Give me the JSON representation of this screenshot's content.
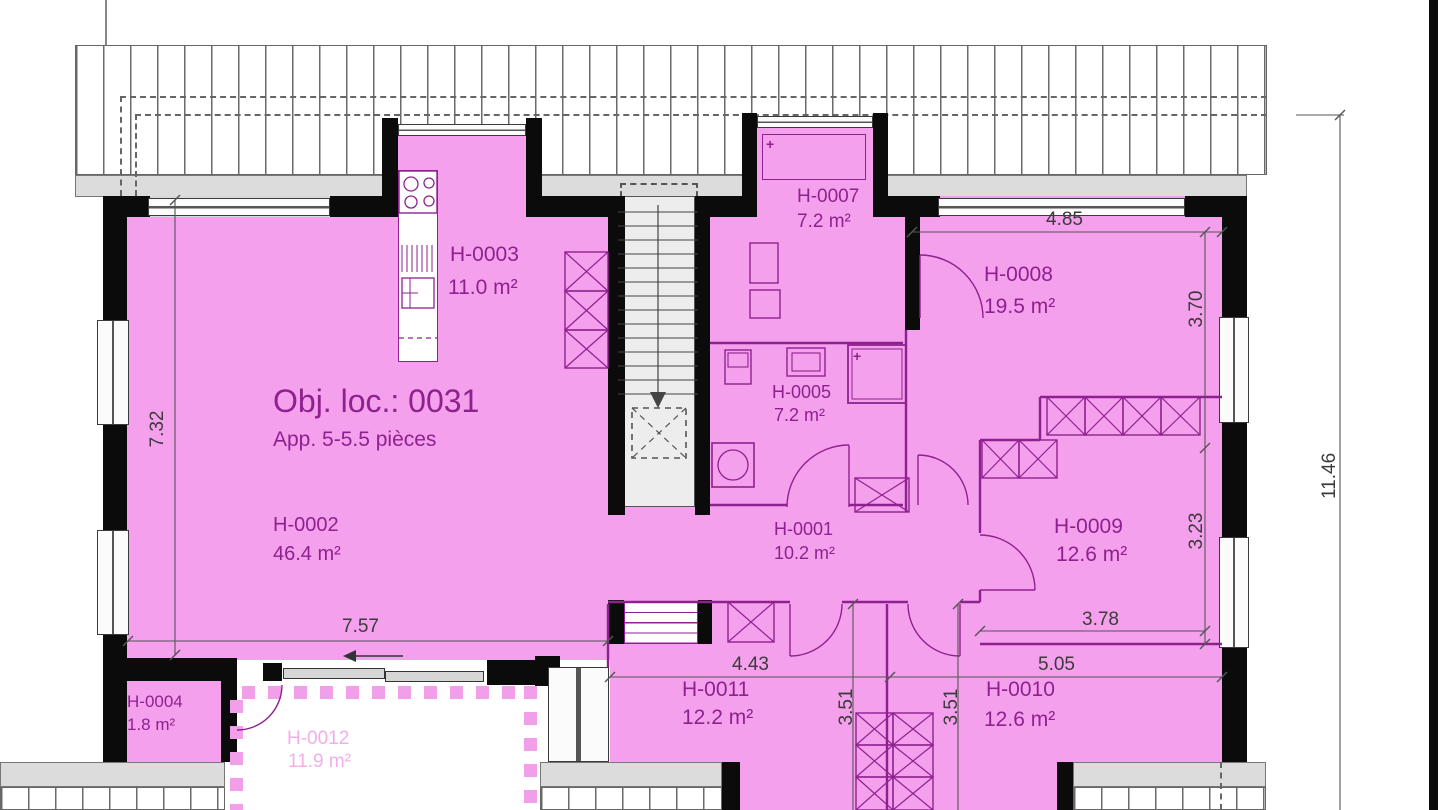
{
  "title": {
    "object": "Obj. loc.: 0031",
    "type": "App. 5-5.5 pièces"
  },
  "rooms": {
    "h0001": {
      "id": "H-0001",
      "area": "10.2 m²"
    },
    "h0002": {
      "id": "H-0002",
      "area": "46.4 m²"
    },
    "h0003": {
      "id": "H-0003",
      "area": "11.0 m²"
    },
    "h0004": {
      "id": "H-0004",
      "area": "1.8 m²"
    },
    "h0005": {
      "id": "H-0005",
      "area": "7.2 m²"
    },
    "h0007": {
      "id": "H-0007",
      "area": "7.2 m²"
    },
    "h0008": {
      "id": "H-0008",
      "area": "19.5 m²"
    },
    "h0009": {
      "id": "H-0009",
      "area": "12.6 m²"
    },
    "h0010": {
      "id": "H-0010",
      "area": "12.6 m²"
    },
    "h0011": {
      "id": "H-0011",
      "area": "12.2 m²"
    },
    "h0012": {
      "id": "H-0012",
      "area": "11.9 m²"
    }
  },
  "dims": {
    "h0008_width": "4.85",
    "h0008_height": "3.70",
    "h0009_height": "3.23",
    "h0009_width": "3.78",
    "h0010_width": "5.05",
    "h0011_width": "4.43",
    "h0011_depth": "3.51",
    "h0010_depth": "3.51",
    "h0002_height": "7.32",
    "h0002_width": "7.57",
    "building_height": "11.46"
  },
  "marks": {
    "plus": "+"
  },
  "colors": {
    "room_fill": "#f5a0ec",
    "line_purple": "#8e2190",
    "balcony_text": "#f1aee9",
    "wall_black": "#0b0b0b",
    "dim_text": "#3b3b3b",
    "roof_gray": "#dcdcdc"
  }
}
